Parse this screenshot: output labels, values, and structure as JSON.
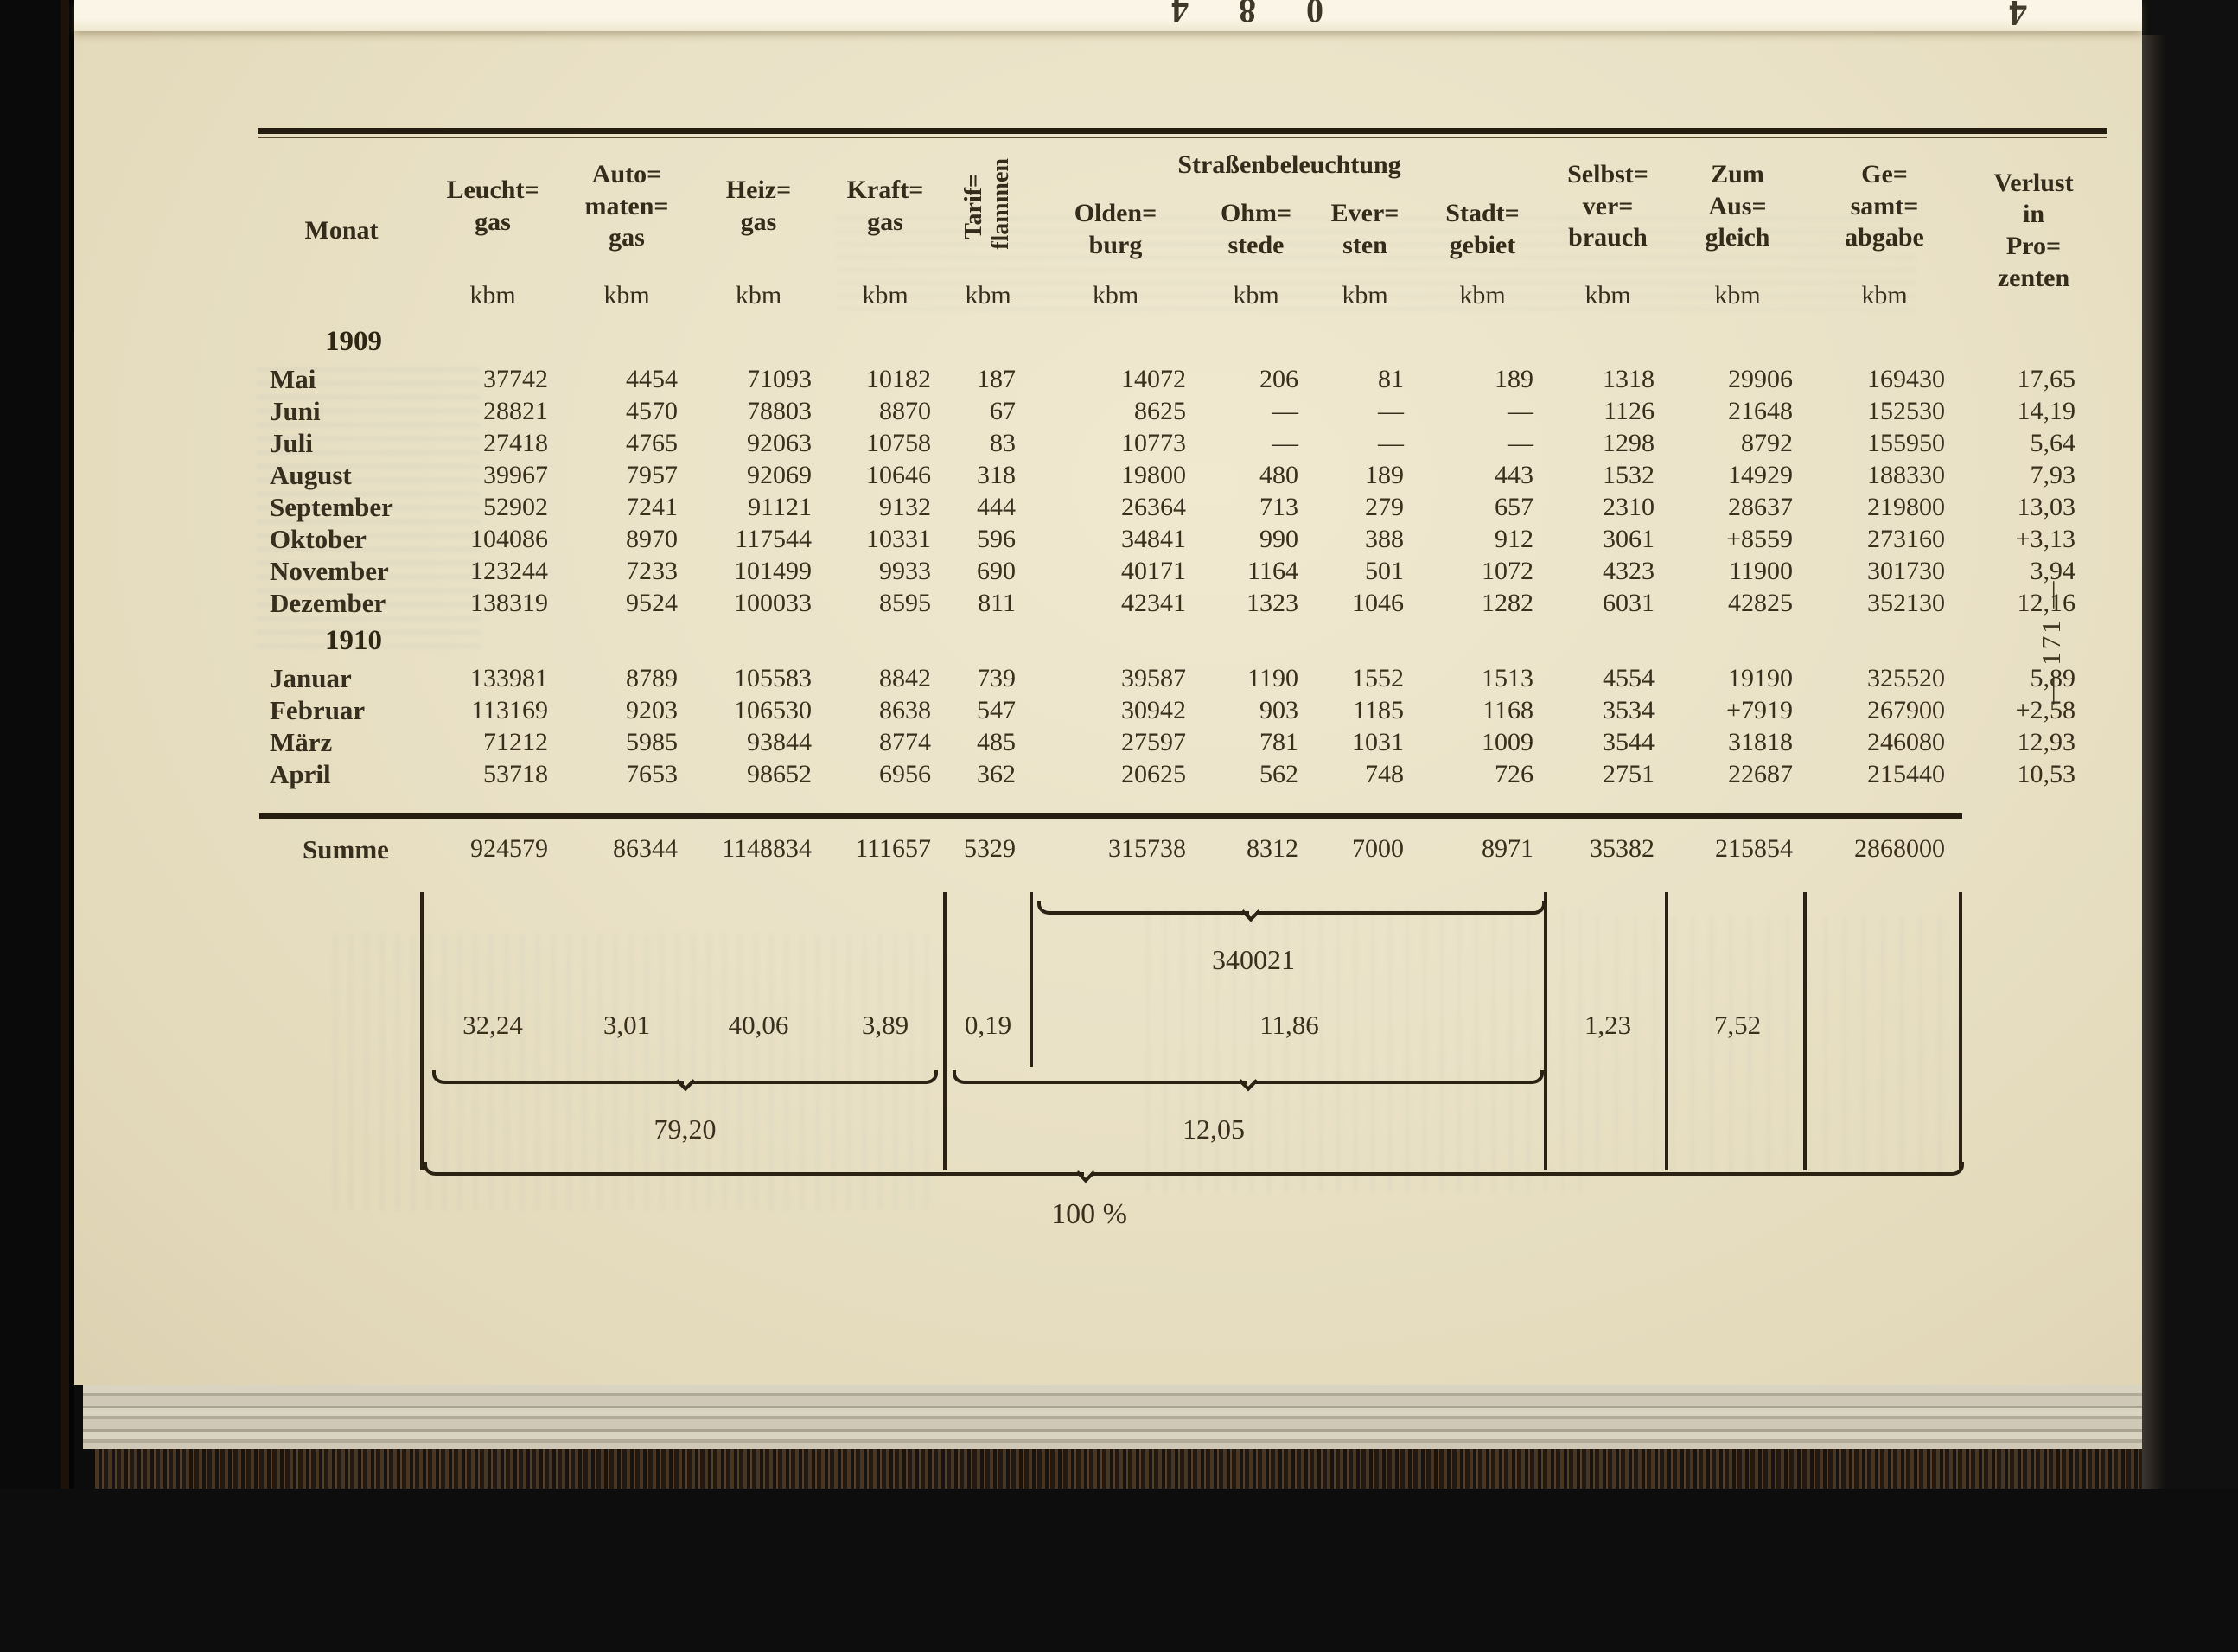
{
  "page": {
    "number_vertical": "— 171 —",
    "top_edge_digits": "5 3 2 3 3 3 3 6 6 0 2 0 8 4",
    "top_corner_mark": "4"
  },
  "table": {
    "header": {
      "monat": "Monat",
      "gas_cols": [
        "Leucht=\ngas",
        "Auto=\nmaten=\ngas",
        "Heiz=\ngas",
        "Kraft=\ngas"
      ],
      "tarif": "Tarif=\nflammen",
      "group": "Straßenbeleuchtung",
      "cities": [
        "Olden=\nburg",
        "Ohm=\nstede",
        "Ever=\nsten",
        "Stadt=\ngebiet"
      ],
      "right_cols": [
        "Selbst=\nver=\nbrauch",
        "Zum\nAus=\ngleich",
        "Ge=\nsamt=\nabgabe"
      ],
      "verlust": "Verlust\nin\nPro=\nzenten",
      "unit": "kbm"
    },
    "sections": [
      {
        "year": "1909",
        "rows": [
          {
            "monat": "Mai",
            "values": [
              "37742",
              "4454",
              "71093",
              "10182",
              "187",
              "14072",
              "206",
              "81",
              "189",
              "1318",
              "29906",
              "169430",
              "17,65"
            ]
          },
          {
            "monat": "Juni",
            "values": [
              "28821",
              "4570",
              "78803",
              "8870",
              "67",
              "8625",
              "—",
              "—",
              "—",
              "1126",
              "21648",
              "152530",
              "14,19"
            ]
          },
          {
            "monat": "Juli",
            "values": [
              "27418",
              "4765",
              "92063",
              "10758",
              "83",
              "10773",
              "—",
              "—",
              "—",
              "1298",
              "8792",
              "155950",
              "5,64"
            ]
          },
          {
            "monat": "August",
            "values": [
              "39967",
              "7957",
              "92069",
              "10646",
              "318",
              "19800",
              "480",
              "189",
              "443",
              "1532",
              "14929",
              "188330",
              "7,93"
            ]
          },
          {
            "monat": "September",
            "values": [
              "52902",
              "7241",
              "91121",
              "9132",
              "444",
              "26364",
              "713",
              "279",
              "657",
              "2310",
              "28637",
              "219800",
              "13,03"
            ]
          },
          {
            "monat": "Oktober",
            "values": [
              "104086",
              "8970",
              "117544",
              "10331",
              "596",
              "34841",
              "990",
              "388",
              "912",
              "3061",
              "+8559",
              "273160",
              "+3,13"
            ]
          },
          {
            "monat": "November",
            "values": [
              "123244",
              "7233",
              "101499",
              "9933",
              "690",
              "40171",
              "1164",
              "501",
              "1072",
              "4323",
              "11900",
              "301730",
              "3,94"
            ]
          },
          {
            "monat": "Dezember",
            "values": [
              "138319",
              "9524",
              "100033",
              "8595",
              "811",
              "42341",
              "1323",
              "1046",
              "1282",
              "6031",
              "42825",
              "352130",
              "12,16"
            ]
          }
        ]
      },
      {
        "year": "1910",
        "rows": [
          {
            "monat": "Januar",
            "values": [
              "133981",
              "8789",
              "105583",
              "8842",
              "739",
              "39587",
              "1190",
              "1552",
              "1513",
              "4554",
              "19190",
              "325520",
              "5,89"
            ]
          },
          {
            "monat": "Februar",
            "values": [
              "113169",
              "9203",
              "106530",
              "8638",
              "547",
              "30942",
              "903",
              "1185",
              "1168",
              "3534",
              "+7919",
              "267900",
              "+2,58"
            ]
          },
          {
            "monat": "März",
            "values": [
              "71212",
              "5985",
              "93844",
              "8774",
              "485",
              "27597",
              "781",
              "1031",
              "1009",
              "3544",
              "31818",
              "246080",
              "12,93"
            ]
          },
          {
            "monat": "April",
            "values": [
              "53718",
              "7653",
              "98652",
              "6956",
              "362",
              "20625",
              "562",
              "748",
              "726",
              "2751",
              "22687",
              "215440",
              "10,53"
            ]
          }
        ]
      }
    ],
    "summe": {
      "label": "Summe",
      "values": [
        "924579",
        "86344",
        "1148834",
        "111657",
        "5329",
        "315738",
        "8312",
        "7000",
        "8971",
        "35382",
        "215854",
        "2868000",
        ""
      ]
    },
    "street_total": "340021",
    "percents": [
      "32,24",
      "3,01",
      "40,06",
      "3,89",
      "0,19",
      "11,86",
      "1,23",
      "7,52"
    ],
    "group_totals": {
      "left": "79,20",
      "mid": "12,05",
      "total": "100 %"
    }
  }
}
